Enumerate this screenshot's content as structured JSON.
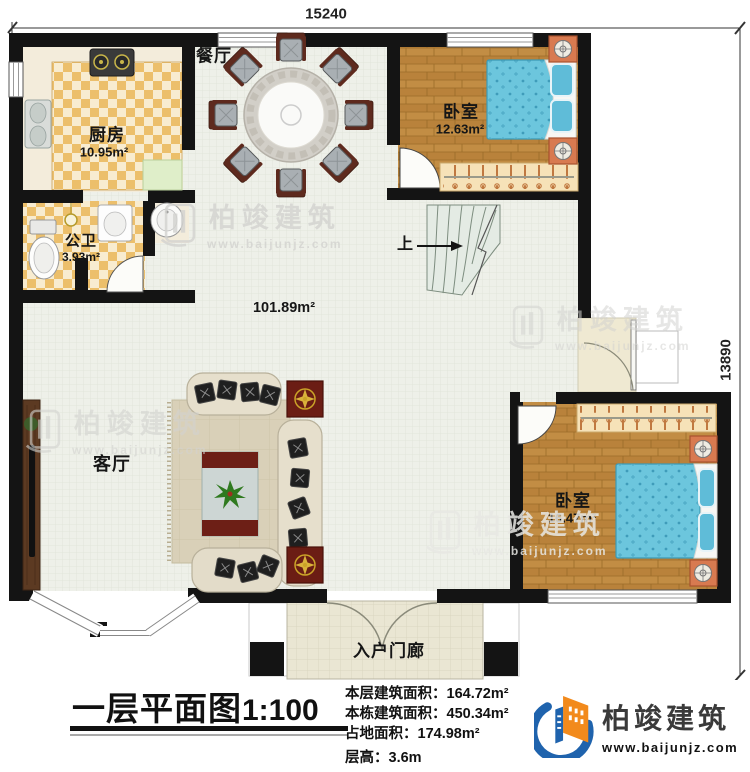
{
  "dimensions": {
    "width_top": "15240",
    "height_right": "13890"
  },
  "rooms": {
    "dining": {
      "label": "餐厅"
    },
    "kitchen": {
      "label": "厨房",
      "area": "10.95m²"
    },
    "bathroom": {
      "label": "公卫",
      "area": "3.93m²"
    },
    "bedroom_top": {
      "label": "卧室",
      "area": "12.63m²"
    },
    "bedroom_right": {
      "label": "卧室",
      "area": "16.47m²"
    },
    "living": {
      "label": "客厅"
    },
    "hall": {
      "area": "101.89m²"
    },
    "porch": {
      "label": "入户门廊"
    },
    "stairs": {
      "label": "上"
    }
  },
  "footer": {
    "title": "一层平面图",
    "scale": "1:100",
    "stats": [
      {
        "label": "本层建筑面积：",
        "value": "164.72m²"
      },
      {
        "label": "本栋建筑面积：",
        "value": "450.34m²"
      },
      {
        "label": "占地面积：",
        "value": "174.98m²"
      },
      {
        "label": "层高：",
        "value": "3.6m"
      }
    ]
  },
  "brand": {
    "name": "柏竣建筑",
    "url": "www.baijunjz.com"
  },
  "watermark": {
    "name": "柏竣建筑",
    "url": "www.baijunjz.com"
  },
  "colors": {
    "wall": "#141414",
    "wood": "#c08a3e",
    "checker": "#ecbf6b",
    "bed_blue": "#6cc6dd",
    "accent_red": "#6b1d14",
    "brand_blue": "#1f63ad",
    "brand_orange": "#f28a1c"
  }
}
